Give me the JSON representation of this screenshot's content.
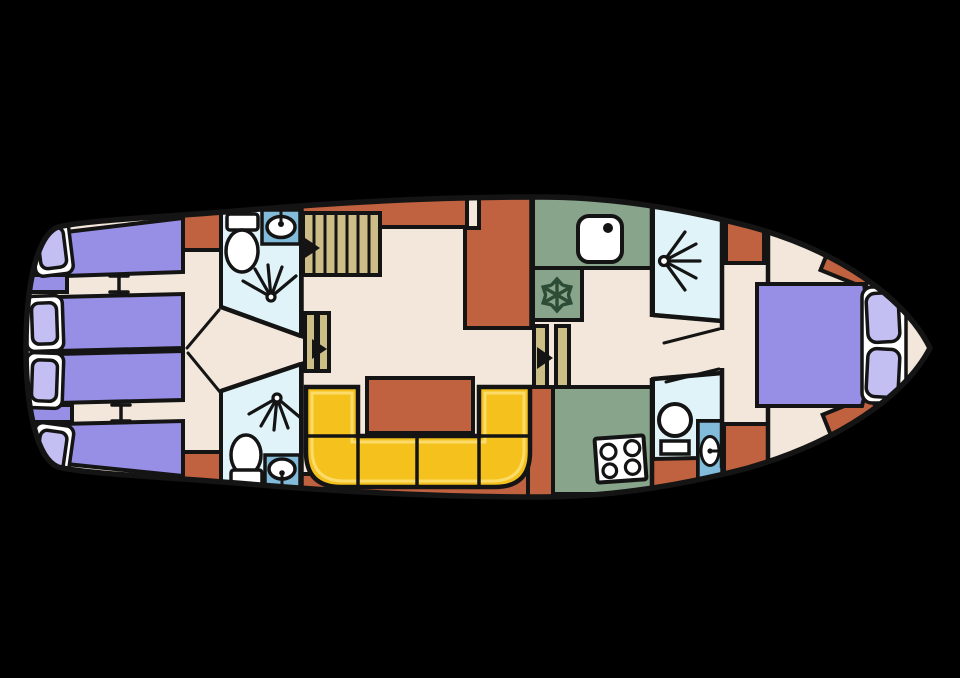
{
  "palette": {
    "background": "#000000",
    "line": "#141414",
    "floor": "#f2e7da",
    "rust": "#c0613f",
    "bed": "#978fe5",
    "pillow": "#c4bff2",
    "bath": "#dff3f8",
    "sink_blue": "#83bcdb",
    "green": "#88a48a",
    "snow_green": "#2c4c36",
    "sofa": "#f5c11d",
    "sofa_inner": "#fbdc6a",
    "tan": "#ccbe86",
    "white": "#ffffff"
  },
  "plan": {
    "orientation": "bow-right",
    "rooms": [
      {
        "name": "aft-cabin",
        "furniture": [
          "single-berth",
          "single-berth",
          "single-berth",
          "single-berth"
        ],
        "pillows": 4
      },
      {
        "name": "aft-bathroom-port",
        "fixtures": [
          "toilet",
          "washbasin",
          "shower"
        ]
      },
      {
        "name": "aft-bathroom-starboard",
        "fixtures": [
          "shower",
          "toilet",
          "washbasin"
        ]
      },
      {
        "name": "saloon",
        "furniture": [
          "companionway-stairs",
          "sideboard",
          "dinette-table",
          "u-shaped-sofa"
        ]
      },
      {
        "name": "galley",
        "fixtures": [
          "sink",
          "refrigerator",
          "stove-4-burners"
        ]
      },
      {
        "name": "fore-shower-room",
        "fixtures": [
          "shower"
        ]
      },
      {
        "name": "fore-toilet-room",
        "fixtures": [
          "toilet",
          "washbasin"
        ]
      },
      {
        "name": "bow-cabin",
        "furniture": [
          "double-berth"
        ],
        "pillows": 2
      }
    ],
    "stairs_steps": 7,
    "stove_burners": 4,
    "sofa_seats": 5
  }
}
